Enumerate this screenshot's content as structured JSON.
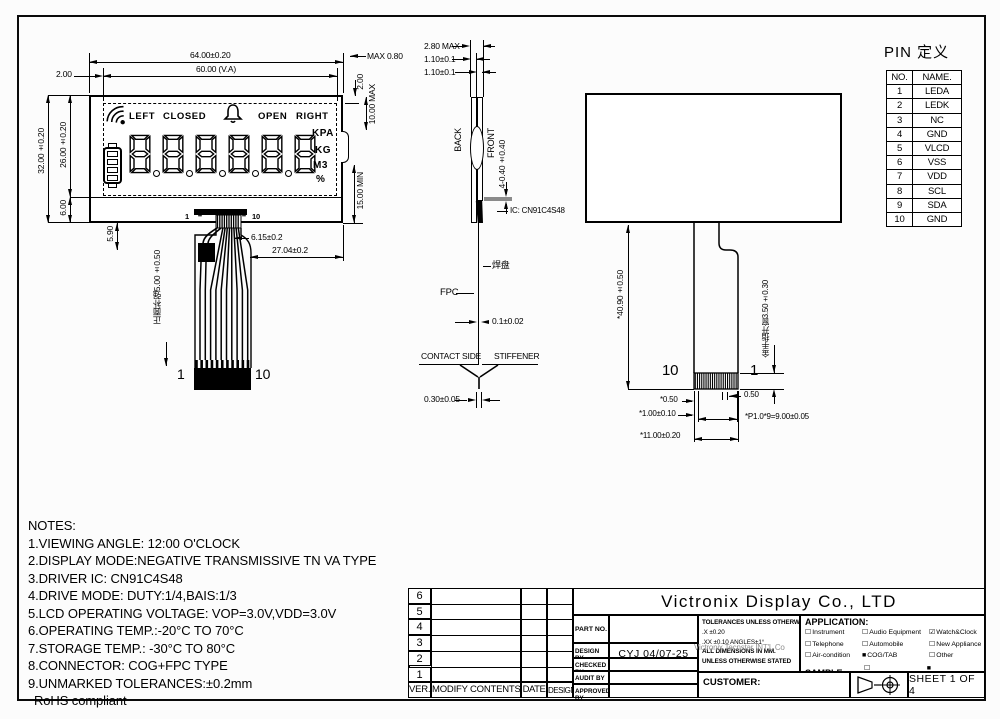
{
  "front_view": {
    "display": {
      "labels": {
        "left": "LEFT",
        "closed": "CLOSED",
        "open": "OPEN",
        "right": "RIGHT"
      },
      "units": [
        "KPA",
        "KG",
        "M3",
        "%"
      ],
      "digit_count": 6,
      "icons": [
        "wifi",
        "bell",
        "battery"
      ]
    },
    "dims": {
      "total_width": "64.00±0.20",
      "va_width": "60.00 (V.A)",
      "left_margin": "2.00",
      "total_height": "32.00±0.20",
      "va_height": "26.00±0.20",
      "bottom_height": "6.00",
      "bump_max": "MAX 0.80",
      "right_margin": "2.00",
      "conn_max": "10.00 MAX",
      "fpc_min": "15.00 MIN",
      "fpc_drop": "5.90",
      "conn_width": "6.15±0.2",
      "fpc_right_offset": "27.04±0.2",
      "stiffener_note": "正面补强5.00±0.50",
      "pin_first_top": "1",
      "pin_last_top": "10",
      "pin_dots": "••",
      "pin_first": "1",
      "pin_last": "10"
    }
  },
  "side_view": {
    "thickness_max": "2.80 MAX",
    "glass1": "1.10±0.1",
    "glass2": "1.10±0.1",
    "back_label": "BACK",
    "front_label": "FRONT",
    "pol_dim": "4-0.40±0.40",
    "ic_label": "IC: CN91C4S48",
    "pad_label": "焊盘",
    "fpc_label": "FPC",
    "fpc_thickness": "0.1±0.02",
    "contact_side": "CONTACT SIDE",
    "stiffener": "STIFFENER",
    "tip_thickness": "0.30±0.05"
  },
  "back_view": {
    "fpc_length": "*40.90±0.50",
    "gold_window": "金手指开窗3.50±0.30",
    "pin_left": "10",
    "pin_right": "1",
    "edge_margin": "*0.50",
    "mid_pitch": "0.50",
    "pin_width": "*1.00±0.10",
    "pitch_total": "*P1.0*9=9.00±0.05",
    "tail_width": "*11.00±0.20"
  },
  "pin_table": {
    "title": "PIN 定义",
    "headers": [
      "NO.",
      "NAME."
    ],
    "rows": [
      [
        "1",
        "LEDA"
      ],
      [
        "2",
        "LEDK"
      ],
      [
        "3",
        "NC"
      ],
      [
        "4",
        "GND"
      ],
      [
        "5",
        "VLCD"
      ],
      [
        "6",
        "VSS"
      ],
      [
        "7",
        "VDD"
      ],
      [
        "8",
        "SCL"
      ],
      [
        "9",
        "SDA"
      ],
      [
        "10",
        "GND"
      ]
    ]
  },
  "notes": {
    "title": "NOTES:",
    "lines": [
      "1.VIEWING ANGLE: 12:00 O'CLOCK",
      "2.DISPLAY MODE:NEGATIVE TRANSMISSIVE TN VA TYPE",
      "3.DRIVER IC: CN91C4S48",
      "4.DRIVE MODE: DUTY:1/4,BAIS:1/3",
      "5.LCD OPERATING VOLTAGE: VOP=3.0V,VDD=3.0V",
      "6.OPERATING TEMP.:-20°C TO 70°C",
      "7.STORAGE TEMP.: -30°C TO 80°C",
      "8.CONNECTOR: COG+FPC TYPE",
      "9.UNMARKED TOLERANCES:±0.2mm",
      "RoHS compliant"
    ]
  },
  "title_block": {
    "company": "Victronix Display Co., LTD",
    "revision": {
      "row_numbers": [
        "6",
        "5",
        "4",
        "3",
        "2",
        "1"
      ],
      "headers": [
        "VER.",
        "MODIFY CONTENTS",
        "DATE",
        "DESIGN"
      ]
    },
    "signatures": {
      "part_no": "PART NO.",
      "design_by": "DESIGN BY",
      "design_value": "CYJ  04/07-25",
      "checked_by": "CHECKED BY",
      "audit_by": "AUDIT  BY",
      "approved_by": "APPROVED BY"
    },
    "tolerances": {
      "line1": "TOLERANCES UNLESS OTHERWISE STATED",
      "line2": ".X  ±0.20",
      "line3": ".XX ±0.10    ANGLES±1°",
      "line4": "ALL DIMENSIONS IN MM.",
      "line5": "UNLESS OTHERWISE STATED",
      "watermark": "Victronix Tecnstar INT'L Co"
    },
    "application": {
      "title": "APPLICATION:",
      "items": [
        {
          "box": "☐",
          "label": "Instrument"
        },
        {
          "box": "☐",
          "label": "Audio Equipment"
        },
        {
          "box": "☑",
          "label": "Watch&Clock"
        },
        {
          "box": "☐",
          "label": "Telephone"
        },
        {
          "box": "☐",
          "label": "Automobile"
        },
        {
          "box": "☐",
          "label": "New Appliance"
        },
        {
          "box": "☐",
          "label": "Air-condition"
        },
        {
          "box": "■",
          "label": "COG/TAB"
        },
        {
          "box": "☐",
          "label": "Other"
        }
      ],
      "sample_label": "SAMPLE:",
      "sample_yes": {
        "box": "☐",
        "label": "Yes"
      },
      "sample_no": {
        "box": "■",
        "label": "No"
      }
    },
    "customer_label": "CUSTOMER:",
    "sheet": "SHEET 1 OF 4"
  }
}
